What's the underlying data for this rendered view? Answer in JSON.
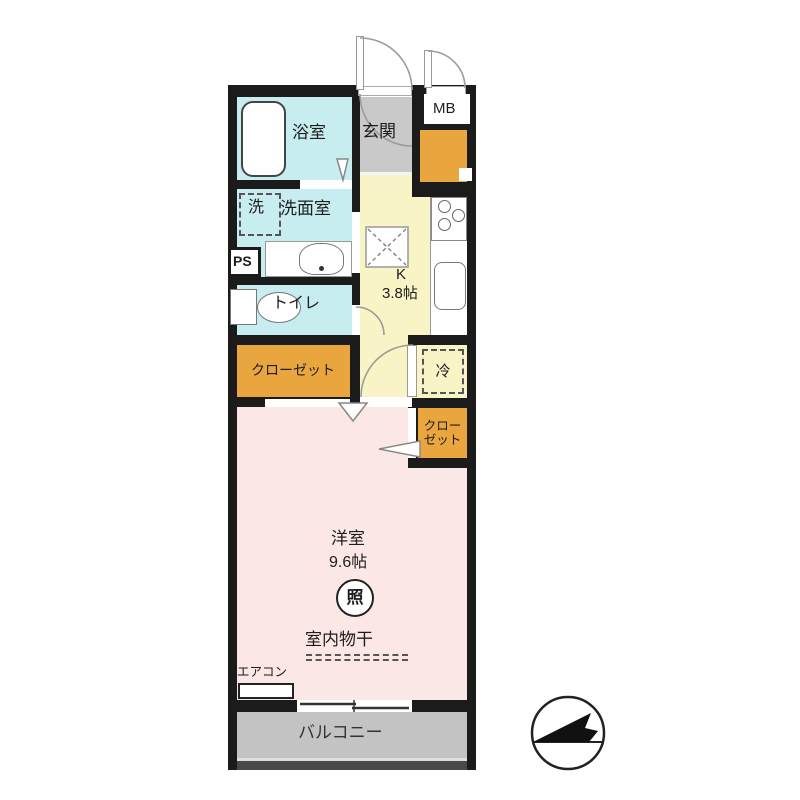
{
  "plan": {
    "rooms": {
      "bathroom": "浴室",
      "washer": "洗",
      "washroom": "洗面室",
      "pipe_space": "PS",
      "toilet": "トイレ",
      "closet_left": "クローゼット",
      "entrance": "玄関",
      "meter_box": "MB",
      "kitchen_label": "K",
      "kitchen_size": "3.8帖",
      "fridge": "冷",
      "closet_right_line1": "クロー",
      "closet_right_line2": "ゼット",
      "living": "洋室",
      "living_size": "9.6帖",
      "ceiling_light": "照",
      "indoor_drying": "室内物干",
      "aircon": "エアコン",
      "balcony": "バルコニー"
    },
    "colors": {
      "wall": "#1b1b1b",
      "wet_area": "#c7edf1",
      "kitchen": "#f8f4c5",
      "entrance": "#c9c9c9",
      "storage": "#e9a63e",
      "living": "#fbe7e5",
      "balcony": "#c3c3c3"
    }
  }
}
